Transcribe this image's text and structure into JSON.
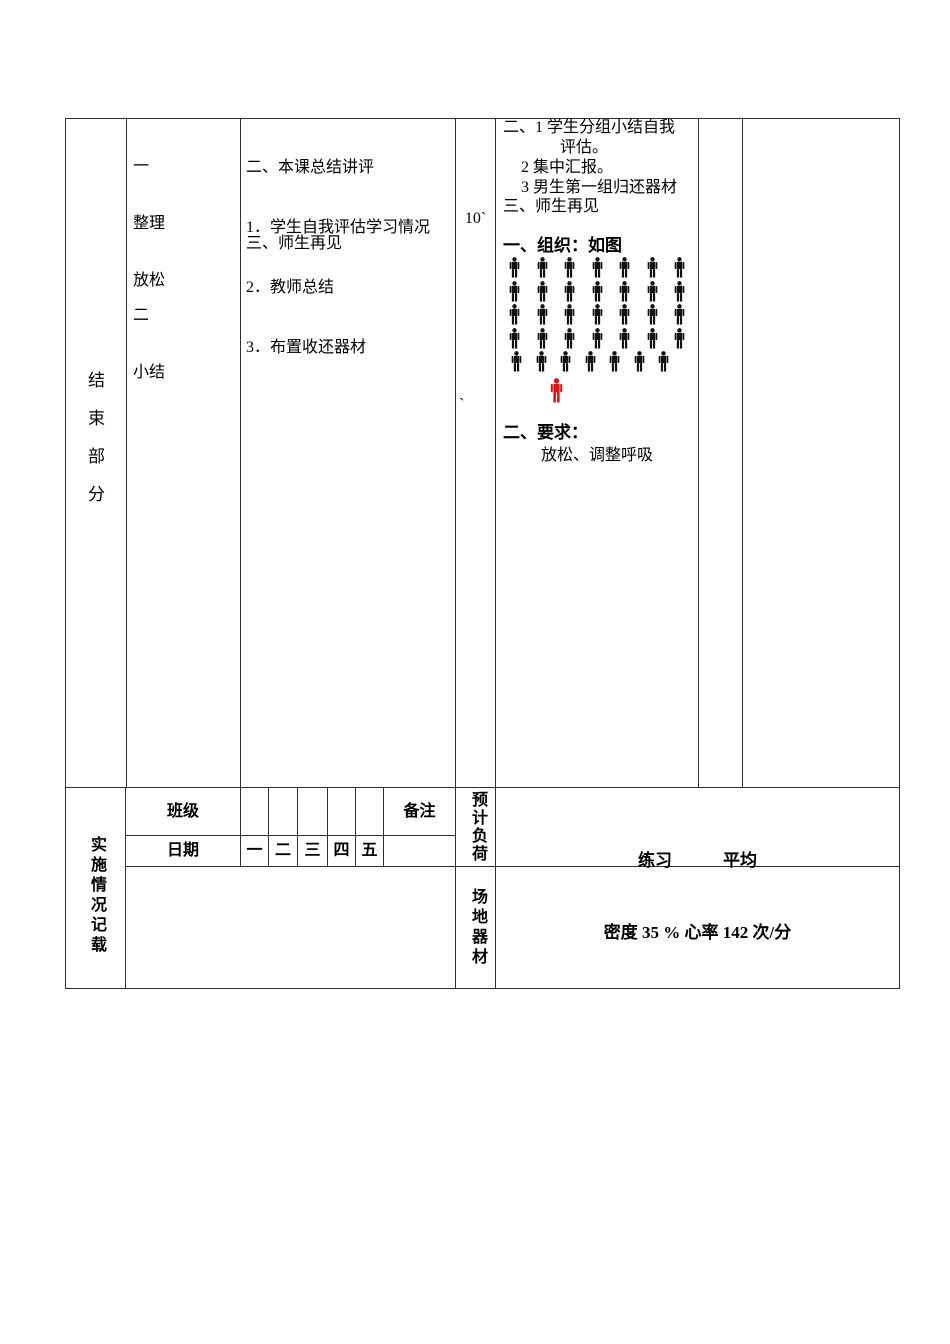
{
  "colors": {
    "border": "#2f2f2f",
    "text": "#000000",
    "student_figure": "#111111",
    "leader_figure": "#dd1414"
  },
  "ending_section": {
    "stage_label": "结束部分",
    "content": {
      "group1_lines": [
        "一",
        "整理",
        "放松"
      ],
      "group2_lines": [
        "二",
        "小结"
      ]
    },
    "teaching": {
      "lines": [
        "二、本课总结讲评",
        "1．学生自我评估学习情况",
        "2．教师总结",
        "3．布置收还器材"
      ],
      "dismissal": "三、师生再见"
    },
    "time": {
      "duration": "10`",
      "stray_mark": "`"
    },
    "organization": {
      "lines": [
        "二、1 学生分组小结自我",
        "评估。",
        "2 集中汇报。",
        "3 男生第一组归还器材",
        "三、师生再见"
      ],
      "org_heading": "一、组织：如图",
      "formation": {
        "row_counts": [
          7,
          7,
          7,
          7,
          7
        ],
        "leader_count": 1
      },
      "req_heading": "二、要求：",
      "req_text": "放松、调整呼吸"
    }
  },
  "record_section": {
    "label": "实施情况记载",
    "class_label": "班级",
    "date_label": "日期",
    "remark_label": "备注",
    "weekdays": [
      "一",
      "二",
      "三",
      "四",
      "五"
    ],
    "load_label": "预计负荷",
    "venue_label": "场地器材",
    "load_line1": "练习　　　平均",
    "load_line2": "密度 35 % 心率 142 次/分"
  }
}
